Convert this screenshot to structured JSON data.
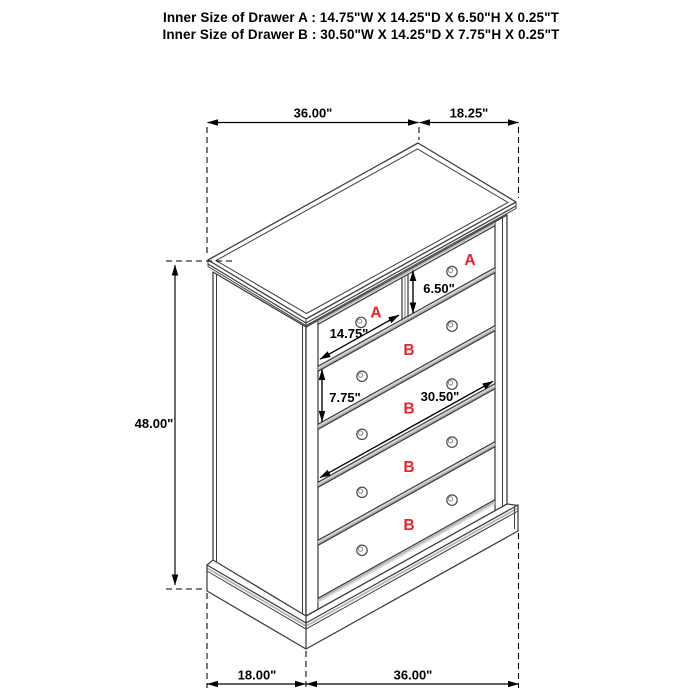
{
  "title": {
    "line_a": "Inner Size of Drawer A : 14.75\"W X 14.25\"D X 6.50\"H X 0.25\"T",
    "line_b": "Inner Size of Drawer B : 30.50\"W X 14.25\"D X 7.75\"H X 0.25\"T"
  },
  "dimensions": {
    "top_width": "36.00\"",
    "top_depth": "18.25\"",
    "height": "48.00\"",
    "base_depth": "18.00\"",
    "base_width": "36.00\"",
    "drawer_a_width": "14.75\"",
    "drawer_a_height": "6.50\"",
    "drawer_b_height": "7.75\"",
    "drawer_b_width": "30.50\""
  },
  "drawers": {
    "label_a": "A",
    "label_b": "B"
  },
  "colors": {
    "outline": "#3e3e3e",
    "shade": "#b2b2b2",
    "shade_light": "#d8d8d8",
    "dimension": "#000000",
    "label_red": "#e8232b",
    "background": "#ffffff"
  }
}
